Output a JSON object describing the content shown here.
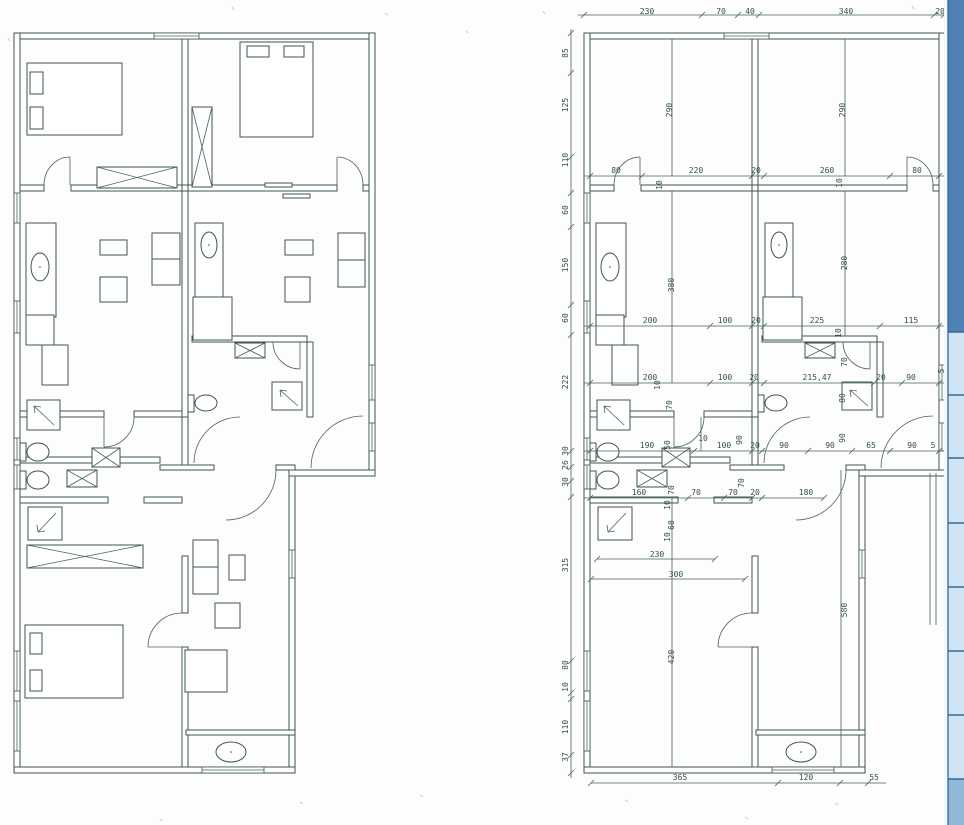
{
  "document": {
    "kind": "scanned architectural floor plan, two plan views (furnished left, dimensioned right)",
    "units_shown": "centimetre dimension figures"
  },
  "palette": {
    "line": "#3c5552",
    "dim_text": "#31504d",
    "paper": "#ffffff",
    "edge_dark": "#4e81b4",
    "edge_light": "#cfe3f2",
    "edge_medium": "#8fb8da",
    "edge_border": "#2f5f8c"
  },
  "dimensions": {
    "labels": [
      {
        "t": "230",
        "x": 63,
        "y": -22
      },
      {
        "t": "70",
        "x": 137,
        "y": -22
      },
      {
        "t": "40",
        "x": 166,
        "y": -22
      },
      {
        "t": "340",
        "x": 262,
        "y": -22
      },
      {
        "t": "20",
        "x": 356,
        "y": -22
      },
      {
        "t": "85",
        "x": -19,
        "y": 20,
        "r": 1
      },
      {
        "t": "125",
        "x": -19,
        "y": 72,
        "r": 1
      },
      {
        "t": "110",
        "x": -19,
        "y": 127,
        "r": 1
      },
      {
        "t": "60",
        "x": -19,
        "y": 177,
        "r": 1
      },
      {
        "t": "150",
        "x": -19,
        "y": 232,
        "r": 1
      },
      {
        "t": "60",
        "x": -19,
        "y": 285,
        "r": 1
      },
      {
        "t": "222",
        "x": -19,
        "y": 349,
        "r": 1
      },
      {
        "t": "30",
        "x": -19,
        "y": 418,
        "r": 1
      },
      {
        "t": "26",
        "x": -19,
        "y": 432,
        "r": 1
      },
      {
        "t": "30",
        "x": -19,
        "y": 449,
        "r": 1
      },
      {
        "t": "315",
        "x": -19,
        "y": 532,
        "r": 1
      },
      {
        "t": "80",
        "x": -19,
        "y": 632,
        "r": 1
      },
      {
        "t": "10",
        "x": -19,
        "y": 654,
        "r": 1
      },
      {
        "t": "110",
        "x": -19,
        "y": 694,
        "r": 1
      },
      {
        "t": "37",
        "x": -19,
        "y": 724,
        "r": 1
      },
      {
        "t": "80",
        "x": 32,
        "y": 137
      },
      {
        "t": "220",
        "x": 112,
        "y": 137
      },
      {
        "t": "20",
        "x": 172,
        "y": 137
      },
      {
        "t": "260",
        "x": 243,
        "y": 137
      },
      {
        "t": "80",
        "x": 333,
        "y": 137
      },
      {
        "t": "10",
        "x": 75,
        "y": 152,
        "r": 1
      },
      {
        "t": "10",
        "x": 255,
        "y": 150,
        "r": 1
      },
      {
        "t": "290",
        "x": 85,
        "y": 77,
        "r": 1
      },
      {
        "t": "290",
        "x": 258,
        "y": 77,
        "r": 1
      },
      {
        "t": "380",
        "x": 87,
        "y": 252,
        "r": 1
      },
      {
        "t": "280",
        "x": 260,
        "y": 230,
        "r": 1
      },
      {
        "t": "200",
        "x": 66,
        "y": 287
      },
      {
        "t": "100",
        "x": 141,
        "y": 287
      },
      {
        "t": "20",
        "x": 172,
        "y": 287
      },
      {
        "t": "225",
        "x": 233,
        "y": 287
      },
      {
        "t": "115",
        "x": 327,
        "y": 287
      },
      {
        "t": "10",
        "x": 254,
        "y": 300,
        "r": 1
      },
      {
        "t": "200",
        "x": 66,
        "y": 344
      },
      {
        "t": "10",
        "x": 73,
        "y": 352,
        "r": 1
      },
      {
        "t": "100",
        "x": 141,
        "y": 344
      },
      {
        "t": "20",
        "x": 170,
        "y": 344
      },
      {
        "t": "215,47",
        "x": 233,
        "y": 344
      },
      {
        "t": "20",
        "x": 297,
        "y": 344
      },
      {
        "t": "90",
        "x": 327,
        "y": 344
      },
      {
        "t": "5",
        "x": 357,
        "y": 338,
        "r": 1
      },
      {
        "t": "70",
        "x": 260,
        "y": 329,
        "r": 1
      },
      {
        "t": "80",
        "x": 258,
        "y": 365,
        "r": 1
      },
      {
        "t": "70",
        "x": 85,
        "y": 372,
        "r": 1
      },
      {
        "t": "10",
        "x": 119,
        "y": 405
      },
      {
        "t": "90",
        "x": 155,
        "y": 407,
        "r": 1
      },
      {
        "t": "90",
        "x": 258,
        "y": 405,
        "r": 1
      },
      {
        "t": "190",
        "x": 63,
        "y": 412
      },
      {
        "t": "50",
        "x": 83,
        "y": 412,
        "r": 1
      },
      {
        "t": "100",
        "x": 140,
        "y": 412
      },
      {
        "t": "20",
        "x": 171,
        "y": 412
      },
      {
        "t": "90",
        "x": 200,
        "y": 412
      },
      {
        "t": "90",
        "x": 246,
        "y": 412
      },
      {
        "t": "65",
        "x": 287,
        "y": 412
      },
      {
        "t": "90",
        "x": 328,
        "y": 412
      },
      {
        "t": "5",
        "x": 349,
        "y": 412
      },
      {
        "t": "160",
        "x": 55,
        "y": 459
      },
      {
        "t": "70",
        "x": 87,
        "y": 457,
        "r": 1
      },
      {
        "t": "70",
        "x": 112,
        "y": 459
      },
      {
        "t": "70",
        "x": 149,
        "y": 459
      },
      {
        "t": "70",
        "x": 157,
        "y": 450,
        "r": 1
      },
      {
        "t": "20",
        "x": 171,
        "y": 459
      },
      {
        "t": "180",
        "x": 222,
        "y": 459
      },
      {
        "t": "10",
        "x": 83,
        "y": 472,
        "r": 1
      },
      {
        "t": "60",
        "x": 87,
        "y": 492,
        "r": 1
      },
      {
        "t": "10",
        "x": 83,
        "y": 504,
        "r": 1
      },
      {
        "t": "230",
        "x": 73,
        "y": 521
      },
      {
        "t": "300",
        "x": 92,
        "y": 541
      },
      {
        "t": "420",
        "x": 87,
        "y": 624,
        "r": 1
      },
      {
        "t": "580",
        "x": 260,
        "y": 577,
        "r": 1
      },
      {
        "t": "365",
        "x": 96,
        "y": 744
      },
      {
        "t": "120",
        "x": 222,
        "y": 744
      },
      {
        "t": "55",
        "x": 290,
        "y": 744
      }
    ],
    "chains": [
      {
        "dir": "h",
        "y": -18,
        "x1": -6,
        "x2": 362,
        "ticks": [
          0,
          118,
          154,
          175,
          350,
          360
        ]
      },
      {
        "dir": "v",
        "x": -13,
        "y1": -4,
        "y2": 745,
        "ticks": [
          0,
          40,
          124,
          160,
          194,
          272,
          302,
          418,
          434,
          448,
          464,
          628,
          660,
          666,
          722,
          740
        ]
      },
      {
        "dir": "h",
        "y": 143,
        "x1": 0,
        "x2": 361,
        "ticks": [
          6,
          58,
          168,
          180,
          306,
          355
        ]
      },
      {
        "dir": "h",
        "y": 293,
        "x1": 0,
        "x2": 361,
        "ticks": [
          6,
          126,
          168,
          180,
          296,
          355
        ]
      },
      {
        "dir": "h",
        "y": 350,
        "x1": 0,
        "x2": 361,
        "ticks": [
          6,
          126,
          168,
          180,
          290,
          318,
          355
        ]
      },
      {
        "dir": "h",
        "y": 418,
        "x1": 0,
        "x2": 361,
        "ticks": [
          6,
          110,
          168,
          178,
          224,
          268,
          306,
          355
        ]
      },
      {
        "dir": "h",
        "y": 465,
        "x1": 0,
        "x2": 240,
        "ticks": [
          6,
          104,
          140,
          168,
          178,
          240
        ]
      },
      {
        "dir": "h",
        "y": 526,
        "x1": 13,
        "x2": 131,
        "ticks": [
          13,
          131
        ]
      },
      {
        "dir": "h",
        "y": 546,
        "x1": 7,
        "x2": 161,
        "ticks": [
          7,
          161
        ]
      },
      {
        "dir": "h",
        "y": 750,
        "x1": 7,
        "x2": 302,
        "ticks": [
          7,
          194,
          256,
          284
        ]
      }
    ]
  }
}
